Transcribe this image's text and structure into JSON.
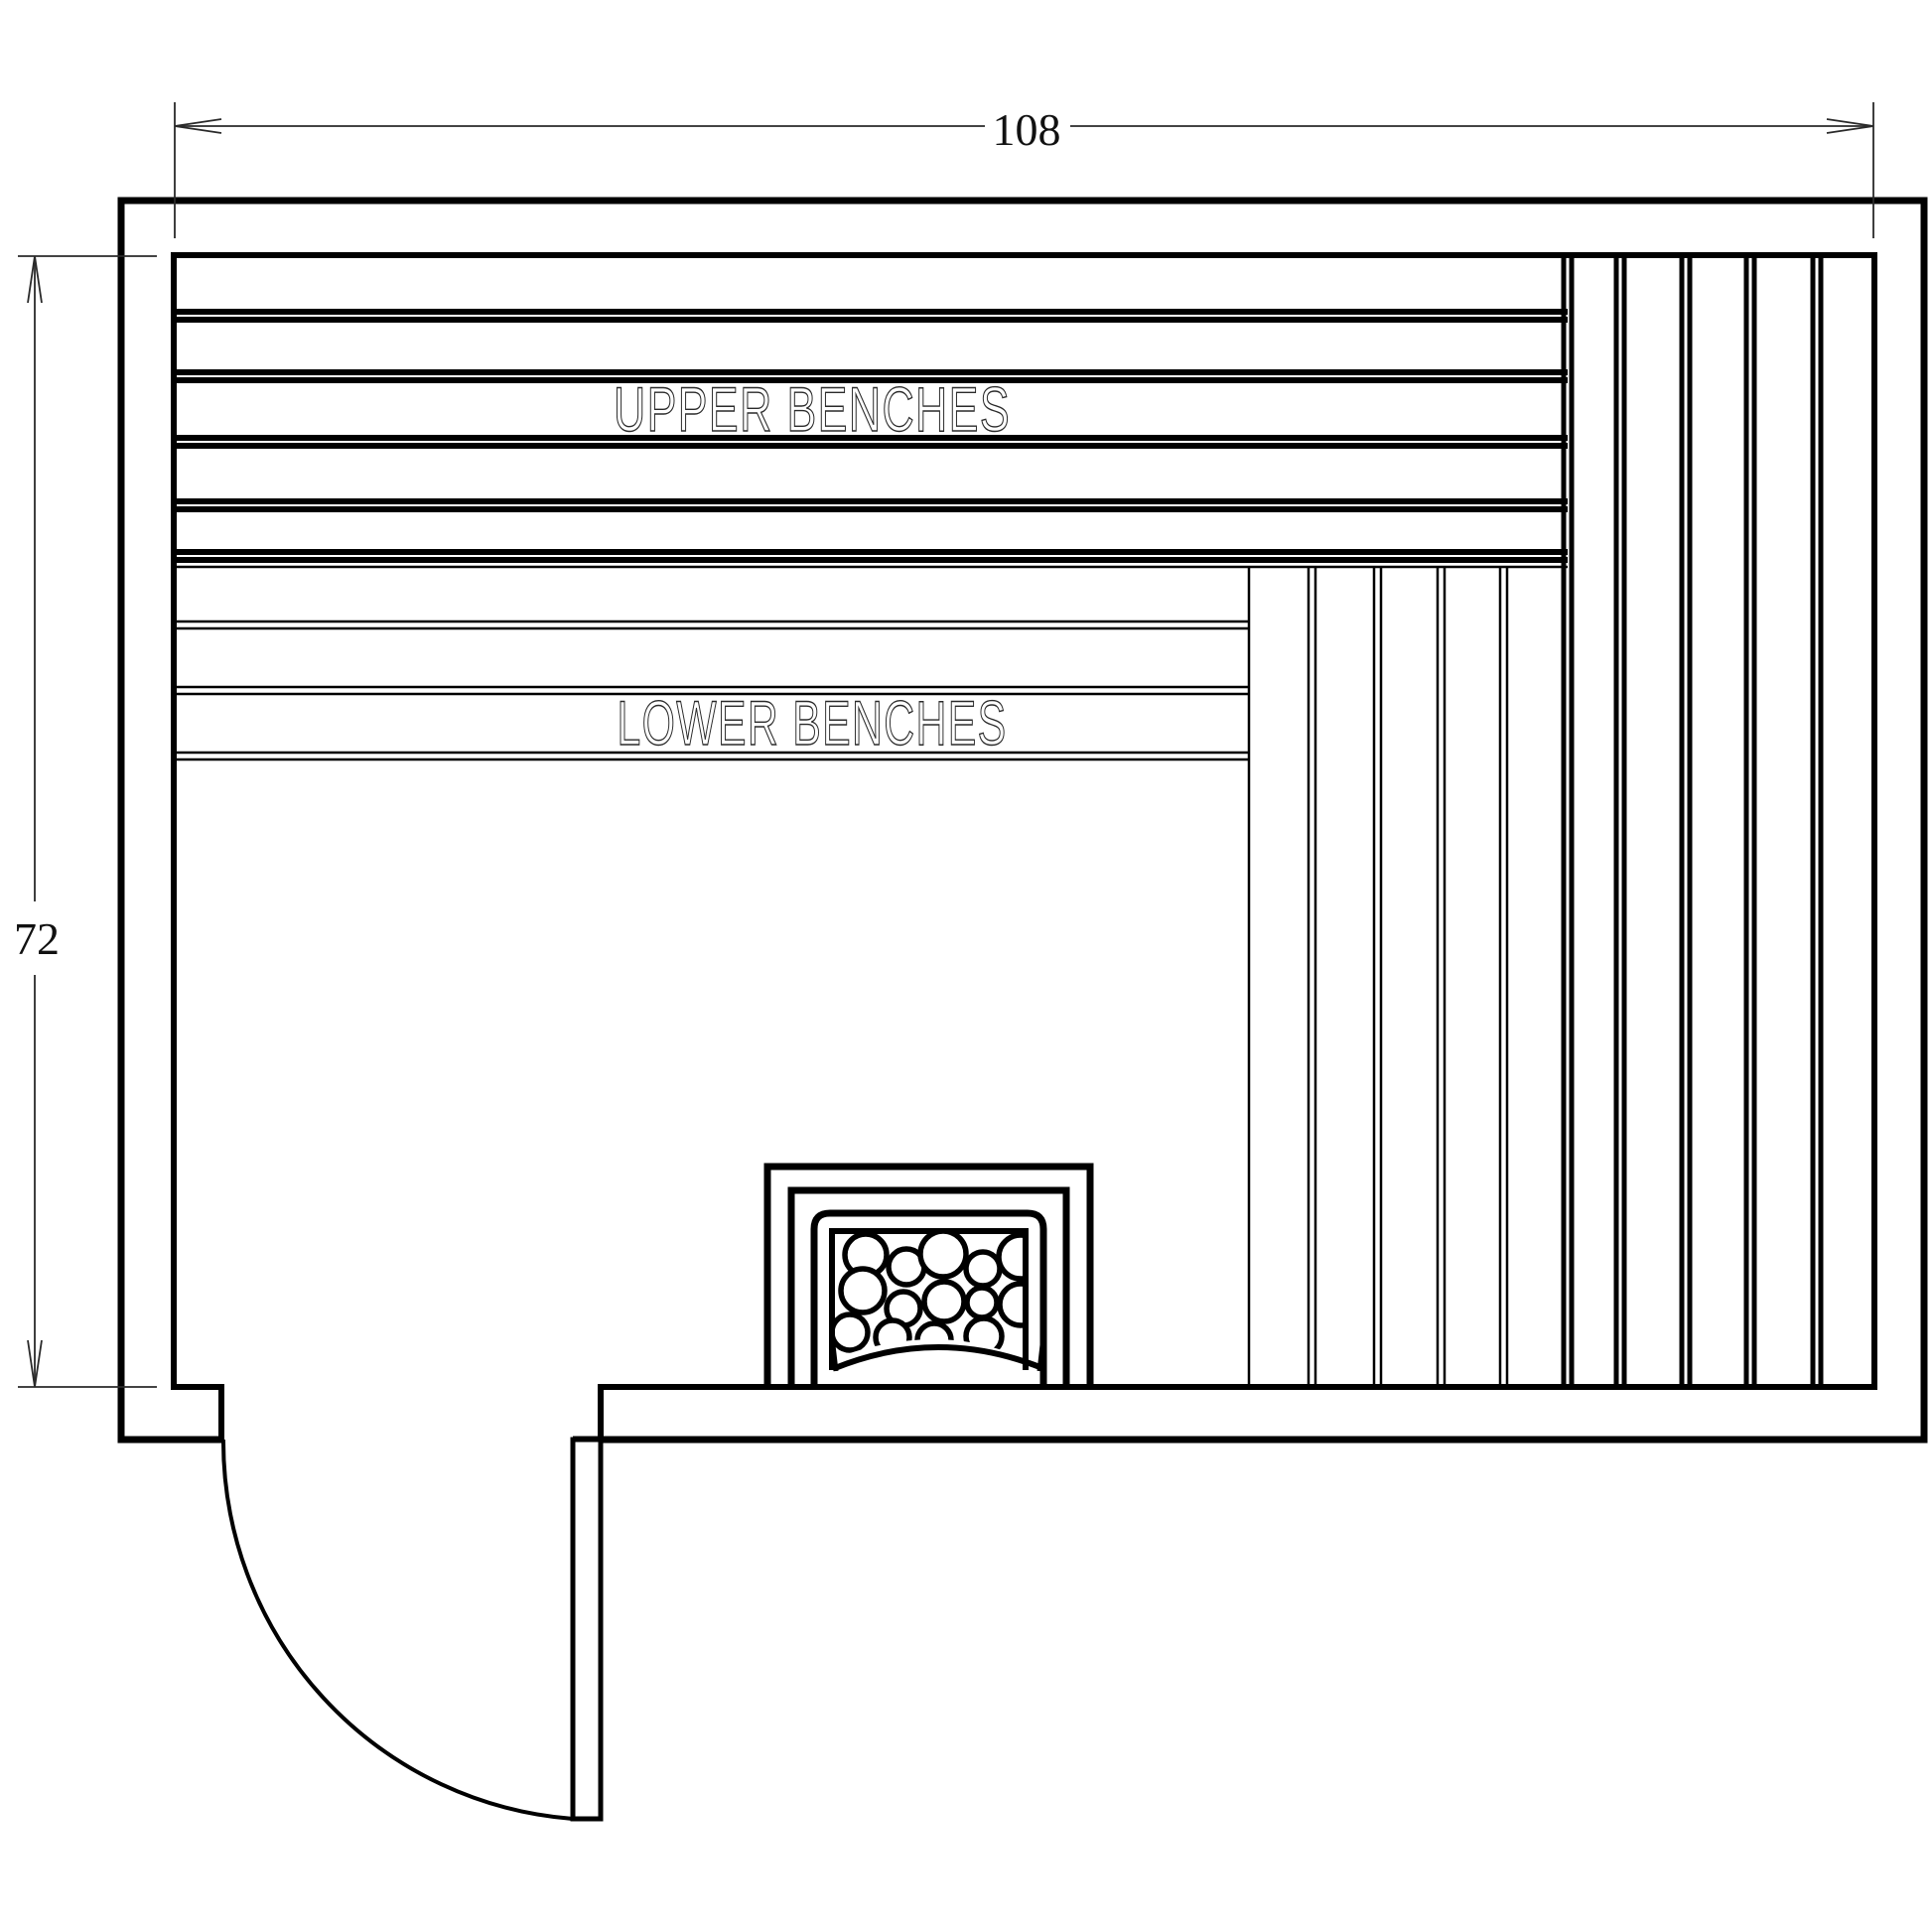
{
  "drawing": {
    "type": "sauna-floor-plan",
    "labels": {
      "upper_benches": "UPPER  BENCHES",
      "lower_benches": "LOWER  BENCHES"
    },
    "dimensions": {
      "width_label": "108",
      "depth_label": "72"
    },
    "colors": {
      "line": "#000000",
      "dimension_line": "#2a2a2a",
      "dimension_text": "#111111",
      "background": "#ffffff"
    }
  }
}
